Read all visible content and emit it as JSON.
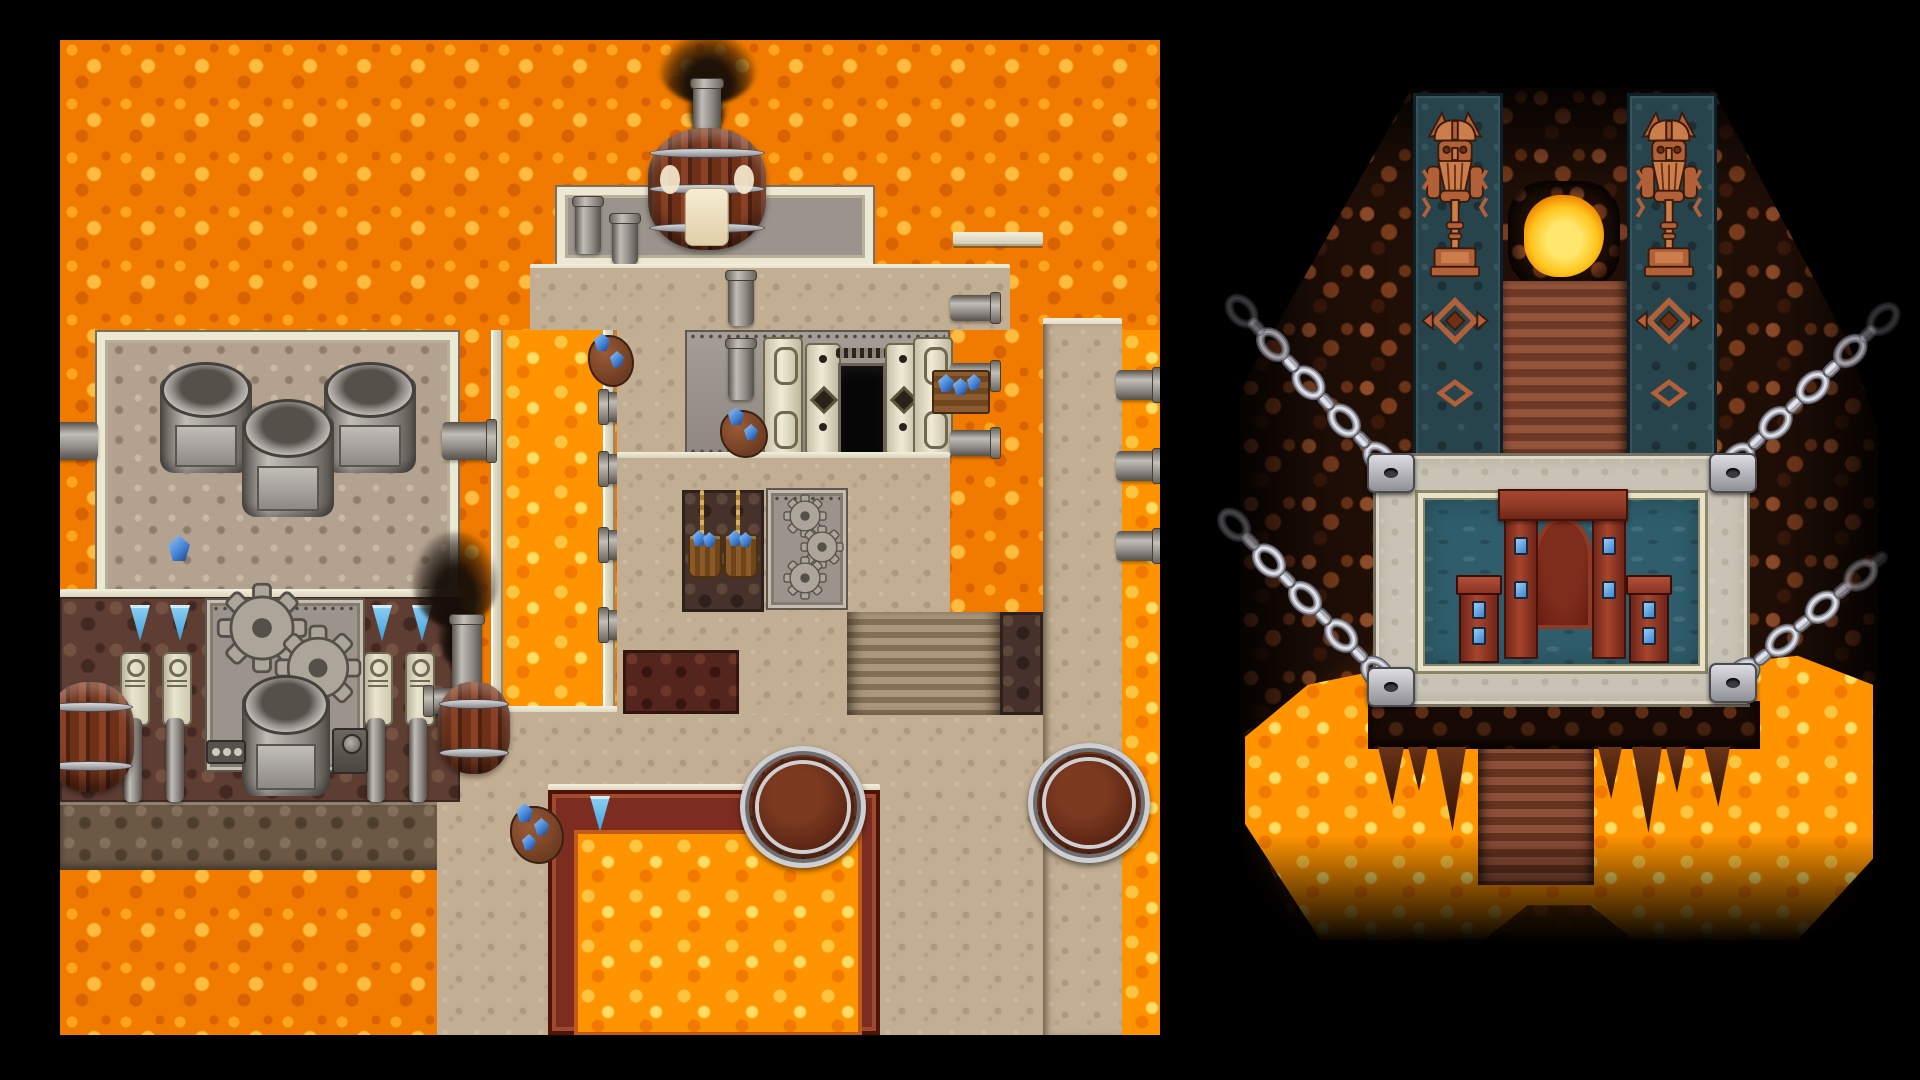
{
  "window": {
    "width": 1920,
    "height": 1080,
    "background": "#000000",
    "visible_text": "none"
  },
  "scene": {
    "style": "two pixel-art top-down RPG tilemap screenshots side by side on a black backdrop",
    "panels": [
      {
        "name": "lava-forge-map",
        "theme": "dwarven forge complex built over a lava field",
        "elements": [
          "orange lava field",
          "stone factory with three rooftop metal vats",
          "side pipes feeding into lava",
          "rock facade with blue pennants, carved pillars, twin gears and smelter machine",
          "wooden side barrels",
          "boiler barrel with chimney and black smoke",
          "entrance facade with black doorway and ornate pillars",
          "two ore buckets of blue crystal hanging over a rock pit",
          "riveted panel with three gears",
          "bright lava channels",
          "stone staircase",
          "stone pier with three drain pipes",
          "lava-filled red forge pit with blue pennant",
          "two large top-view barrels",
          "blue crystal ore deposits",
          "small smoking chimney"
        ]
      },
      {
        "name": "shrine-cavern-map",
        "theme": "volcanic cavern shrine on a chained platform",
        "elements": [
          "black void backdrop",
          "red-brown cave rock mass",
          "two teal totem pillars carved with dwarf warriors holding hammers",
          "diamond carvings",
          "glowing lava portal",
          "staircase descending to platform",
          "gray stone platform",
          "pool of teal water with cream frame",
          "mahogany shrine arch with gem pillars",
          "two gem altars in the water",
          "four corner chain anchors",
          "four giant steel chains stretching to the cave walls",
          "rock ledge with stalactites",
          "lava pool",
          "staircase descending into darkness"
        ]
      }
    ]
  },
  "colors": {
    "bg": "#000000",
    "lava-base": "#f07b00",
    "lava-hi": "#ffa41e",
    "lava-hi2": "#ffbc3e",
    "lava-dk": "#d96200",
    "lava2-base": "#ff9400",
    "lava2-hi": "#ffc440",
    "lava2-hi2": "#ffdd66",
    "lava2-dk": "#f27900",
    "path": "#c2ae92",
    "path-hi": "#d8c9af",
    "path-dk": "#8f7d63",
    "cream": "#ece8d4",
    "cream-dk": "#b6b098",
    "line-dk": "#6e6754",
    "gray-wall": "#9b948c",
    "gray-hi": "#b5afa7",
    "gray-dk": "#6e6760",
    "roof-tan": "#b4a291",
    "roof-hi": "#c8b8a6",
    "roof-dk": "#8e7d6c",
    "metal": "#8e8984",
    "metal-hi": "#c0bcb6",
    "metal-dk": "#55504a",
    "rockwall": "#5e3d33",
    "rockwall-hi": "#755142",
    "rockwall-dk": "#432922",
    "ledge": "#6b5945",
    "ledge-hi": "#82705a",
    "ledge-dk": "#4e3e2d",
    "pit": "#46322a",
    "pit-hi": "#5d463a",
    "pit-dk": "#2e201a",
    "redrock": "#54251c",
    "redrock-hi": "#6e352a",
    "redrock-dk": "#38150f",
    "forge": "#7c2d1f",
    "forge-hi": "#9c4a30",
    "forge-dk": "#511308",
    "forge-inner": "#c05a18",
    "barrel": "#6e3118",
    "barrel-hi": "#8a4226",
    "barrel-dk": "#4e2212",
    "barrel-top": "#5a2413",
    "barrel-top-hi": "#7c3a20",
    "band": "#cfcfd2",
    "band-dk": "#6e6e72",
    "crystal": "#3f7fd4",
    "crystal-hi": "#9cc8f0",
    "crystal-dk": "#1d3f78",
    "banner-blue": "#3f9ddb",
    "banner-blue-hi": "#8ed2f4",
    "smoke": "#191009",
    "cave-base": "#200f07",
    "cave-hi": "#8f4d2a",
    "cave-md": "#6b3317",
    "cave-md2": "#7b3c1d",
    "cave-dk": "#3c1a0b",
    "teal": "#27434c",
    "teal-dk": "#0e2026",
    "teal-hi": "#35545e",
    "copper": "#b26038",
    "copper-hi": "#cb7d4b",
    "copper-dk": "#6e3014",
    "plat": "#c9c3b5",
    "plat-dk": "#77715f",
    "plat-hi": "#ddd8c8",
    "water": "#2f5d6b",
    "water-dk": "#244b57",
    "frame-cream": "#e8e2ca",
    "frame-dk": "#8a8766",
    "arch-red": "#8e3a26",
    "arch-red-hi": "#a8452e",
    "arch-red-dk": "#451108",
    "arch-inner": "#61190e",
    "gem-blue": "#3d84cf",
    "gem-hi": "#9ccdf2",
    "chain-hi": "#e2e2ea",
    "chain-md": "#a9a9b4",
    "chain-dk": "#5c5c64",
    "stair-a": "#ab977d",
    "stair-b": "#837054",
    "stairR-a": "#8d4f36",
    "stairR-b": "#64331f",
    "glow-core": "#ffe76e",
    "glow-mid": "#ffc51e"
  }
}
